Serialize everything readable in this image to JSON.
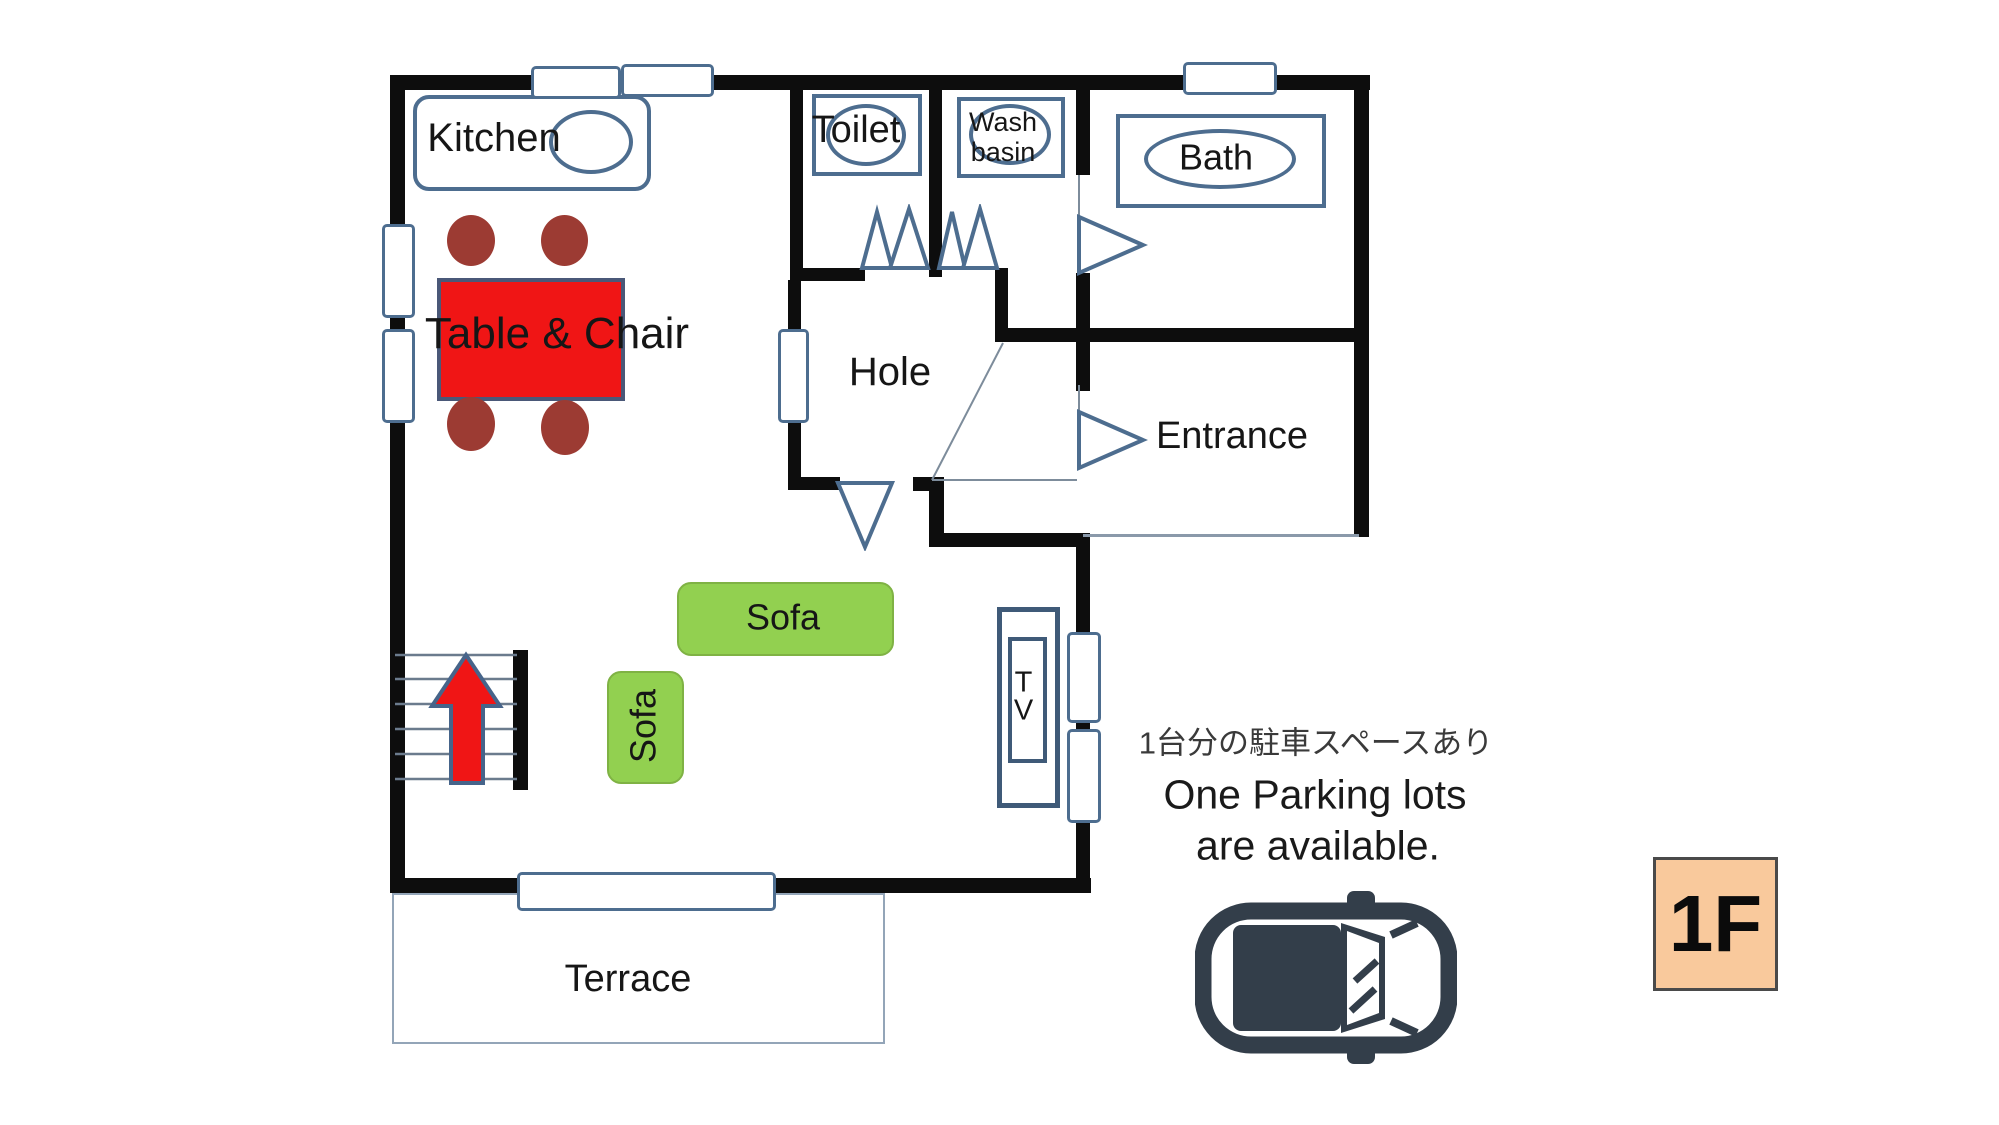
{
  "title": "1F floor plan",
  "labels": {
    "kitchen": "Kitchen",
    "toilet": "Toilet",
    "wash_line1": "Wash",
    "wash_line2": "basin",
    "bath": "Bath",
    "hole": "Hole",
    "entrance": "Entrance",
    "table": "Table & Chair",
    "sofa_long": "Sofa",
    "sofa_vert": "Sofa",
    "tv": "TV",
    "terrace": "Terrace",
    "floor_badge": "1F"
  },
  "parking_note": {
    "jp": "1台分の駐車スペースあり",
    "en_line1": "One Parking lots",
    "en_line2": "are available."
  },
  "icons": {
    "car": "car-top-view-icon",
    "stairs_arrow": "up-arrow-icon",
    "doors": "door-swing-icon",
    "windows": "window-symbol"
  },
  "colors": {
    "wall": "#0d0d0d",
    "outline_blue": "#4d6d8f",
    "thin_line": "#8a99aa",
    "table_red": "#f01515",
    "chair_brown": "#9c3b33",
    "sofa_green": "#92d050",
    "arrow_red": "#f01515",
    "car_dark": "#333e4a",
    "badge_peach": "#f9c99c"
  }
}
